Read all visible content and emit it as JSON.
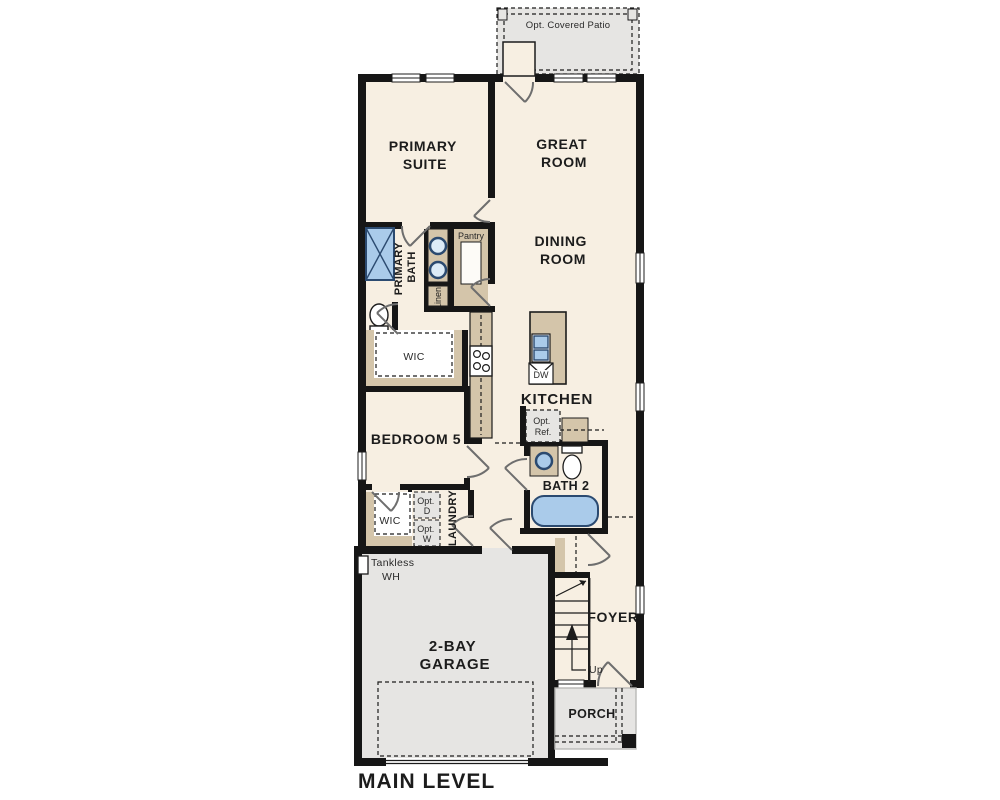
{
  "plan": {
    "title": "MAIN LEVEL",
    "type": "floor-plan"
  },
  "colors": {
    "wall": "#161616",
    "floor": "#f7efe2",
    "optional_gray": "#e6e5e3",
    "cabinet_tan": "#d4c5aa",
    "fixture_blue": "#aacbea",
    "fixture_border": "#2b4a70"
  },
  "labels": {
    "patio": "Opt. Covered Patio",
    "primary_suite": [
      "PRIMARY",
      "SUITE"
    ],
    "great_room": [
      "GREAT",
      "ROOM"
    ],
    "dining_room": [
      "DINING",
      "ROOM"
    ],
    "pantry": "Pantry",
    "primary_bath": [
      "PRIMARY",
      "BATH"
    ],
    "linen": "Linen",
    "wic_primary": "WIC",
    "kitchen": "KITCHEN",
    "dw": "DW",
    "opt_ref": [
      "Opt.",
      "Ref."
    ],
    "bedroom5": "BEDROOM 5",
    "bath2": "BATH 2",
    "wic_bedroom5": "WIC",
    "opt_dryer": [
      "Opt.",
      "D"
    ],
    "opt_washer": [
      "Opt.",
      "W"
    ],
    "laundry": "LAUNDRY",
    "tankless": [
      "Tankless",
      "WH"
    ],
    "garage": [
      "2-BAY",
      "GARAGE"
    ],
    "foyer": "FOYER",
    "up": "Up",
    "porch": "PORCH"
  }
}
